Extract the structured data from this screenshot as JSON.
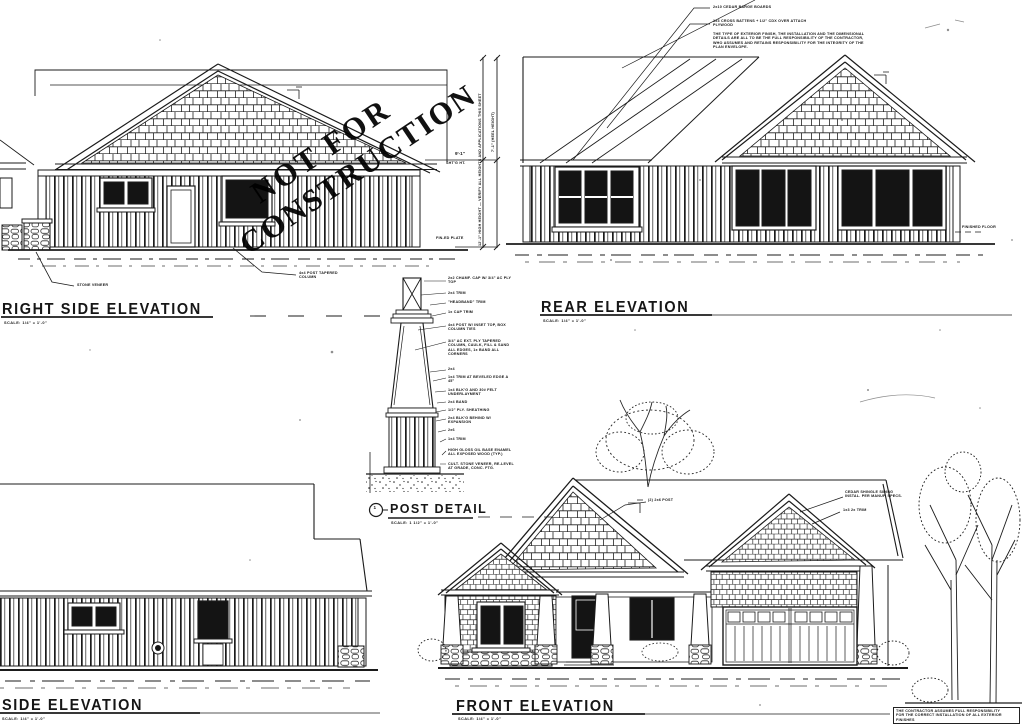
{
  "meta": {
    "paper": "#ffffff",
    "ink": "#1b1b1b",
    "glass": "#141414"
  },
  "stamp": {
    "line1": "NOT FOR",
    "line2": "CONSTRUCTION"
  },
  "titles": {
    "right_side": {
      "label": "RIGHT SIDE ELEVATION",
      "scale": "SCALE: 1/4\" = 1'-0\""
    },
    "rear": {
      "label": "REAR ELEVATION",
      "scale": "SCALE: 1/4\" = 1'-0\""
    },
    "front": {
      "label": "FRONT ELEVATION",
      "scale": "SCALE: 1/4\" = 1'-0\""
    },
    "side": {
      "label": "SIDE ELEVATION",
      "scale": "SCALE: 1/4\" = 1'-0\""
    },
    "post": {
      "marker": "1",
      "label": "POST DETAIL",
      "scale": "SCALE: 1 1/2\" = 1'-0\""
    }
  },
  "notes": {
    "barge": "2x10 CEDAR BARGE BOARDS",
    "battens": "1x3 CROSS BATTENS + 1/2\" CDX OVER ATTACH PLYWOOD",
    "disclaimer": "THE TYPE OF EXTERIOR FINISH, THE INSTALLATION AND THE DIMENSIONAL DETAILS ARE ALL TO BE THE FULL RESPONSIBILITY OF THE CONTRACTOR, WHO ASSUMES AND RETAINS RESPONSIBILITY FOR THE INTEGRITY OF THE PLAN ENVELOPE.",
    "contractor_line1": "THE CONTRACTOR ASSUMES FULL RESPONSIBILITY",
    "contractor_line2": "FOR THE CORRECT INSTALLATION OF ALL EXTERIOR FINISHES"
  },
  "dims": {
    "heel": "7'-1\" (HEEL HEIGHT)",
    "wall_note": "12'-1\" HIGH HEIGHT — VERIFY ALL HEIGHTS AND APPLICATIONS THIS SHEET",
    "plate": "9'-1\"",
    "shtg": "SHT'G HT.",
    "fin_plate": "FIN-ED PLATE",
    "fin_floor": "FINISHED FLOOR"
  },
  "labels": {
    "stone_veneer": "STONE VENEER",
    "post_taper": "4x4 POST TAPERED COLUMN",
    "front_post": "(2) 2x6 POST",
    "shingle_note": "CEDAR SHINGLE SIDING INSTAL. PER MANUF. SPECS.",
    "trim_note": "1x3 2x TRIM"
  },
  "post_callouts": [
    "2x2 CHAMF. CAP W/ 3/4\" AC PLY TOP",
    "2x4 TRIM",
    "\"HEADBAND\" TRIM",
    "1x CAP TRIM",
    "4x4 POST W/ INSET TOP, BOX COLUMN TIES",
    "3/4\" AC EXT. PLY TAPERED COLUMN, CAULK, FILL & SAND ALL EDGES, 1x BAND ALL CORNERS",
    "2x4",
    "1x4 TRIM AT BEVELED EDGE A 45°",
    "1x4 BLK'G AND 30# FELT UNDERLAYMENT",
    "2x4 BAND",
    "1/2\" PLY. SHEATHING",
    "2x4 BLK'G BEHIND W/ EXPANSION",
    "2x6",
    "1x4 TRIM",
    "HIGH GLOSS OIL BASE ENAMEL ALL EXPOSED WOOD (TYP.)",
    "CULT. STONE VENEER, RE-LEVEL AT GRADE, CONC. FTG."
  ]
}
